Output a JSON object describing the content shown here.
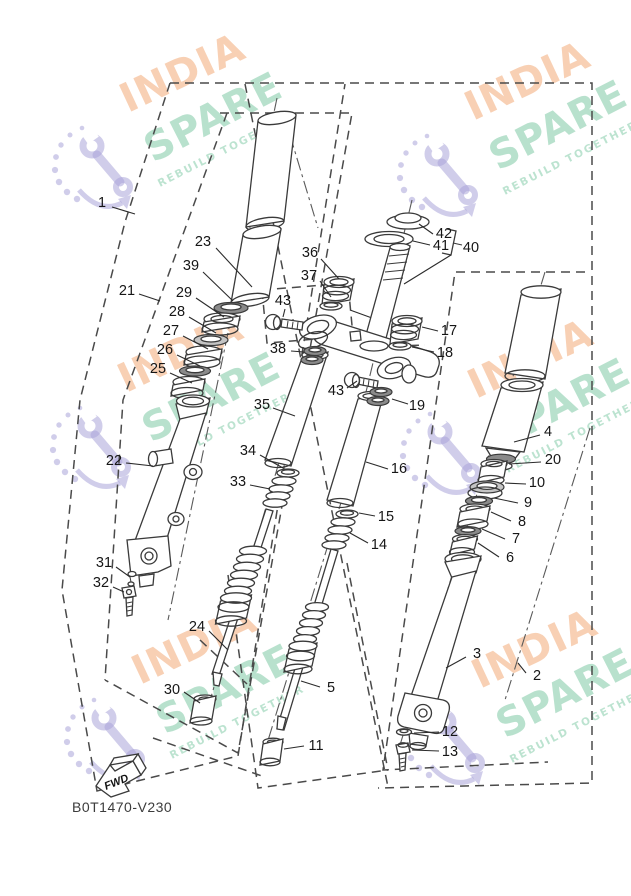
{
  "watermark": {
    "brand_top": "INDIA",
    "brand_bottom": "SPARE",
    "tagline": "REBUILD TOGETHER"
  },
  "footer": {
    "part_code": "B0T1470-V230",
    "fwd_label": "FWD"
  },
  "colors": {
    "line": "#3a3a3a",
    "watermark_orange": "#f4b182",
    "watermark_green": "#7ec9a4",
    "watermark_purple": "#aaa4d8"
  },
  "callouts": [
    {
      "n": "1",
      "x": 102,
      "y": 207,
      "l": [
        112,
        207,
        135,
        214
      ]
    },
    {
      "n": "21",
      "x": 127,
      "y": 295,
      "l": [
        139,
        294,
        160,
        301
      ]
    },
    {
      "n": "23",
      "x": 203,
      "y": 246,
      "l": [
        216,
        248,
        252,
        287
      ]
    },
    {
      "n": "39",
      "x": 191,
      "y": 270,
      "l": [
        203,
        272,
        233,
        301
      ]
    },
    {
      "n": "29",
      "x": 184,
      "y": 297,
      "l": [
        196,
        298,
        224,
        317
      ]
    },
    {
      "n": "28",
      "x": 177,
      "y": 316,
      "l": [
        189,
        317,
        216,
        333
      ]
    },
    {
      "n": "27",
      "x": 171,
      "y": 335,
      "l": [
        183,
        336,
        208,
        349
      ]
    },
    {
      "n": "26",
      "x": 165,
      "y": 354,
      "l": [
        177,
        355,
        200,
        366
      ]
    },
    {
      "n": "25",
      "x": 158,
      "y": 373,
      "l": [
        170,
        373,
        192,
        383
      ]
    },
    {
      "n": "22",
      "x": 114,
      "y": 465,
      "l": [
        126,
        463,
        153,
        466
      ]
    },
    {
      "n": "31",
      "x": 104,
      "y": 567,
      "l": [
        116,
        567,
        130,
        577
      ]
    },
    {
      "n": "32",
      "x": 101,
      "y": 587,
      "l": [
        113,
        587,
        124,
        592
      ]
    },
    {
      "n": "24",
      "x": 197,
      "y": 631,
      "l": [
        209,
        631,
        228,
        650
      ]
    },
    {
      "n": "30",
      "x": 172,
      "y": 694,
      "l": [
        184,
        692,
        200,
        703
      ]
    },
    {
      "n": "35",
      "x": 262,
      "y": 409,
      "l": [
        273,
        408,
        295,
        416
      ]
    },
    {
      "n": "34",
      "x": 248,
      "y": 455,
      "l": [
        260,
        455,
        283,
        468
      ]
    },
    {
      "n": "33",
      "x": 238,
      "y": 486,
      "l": [
        250,
        485,
        270,
        489
      ]
    },
    {
      "n": "36",
      "x": 310,
      "y": 257,
      "l": [
        321,
        259,
        339,
        279
      ]
    },
    {
      "n": "37",
      "x": 309,
      "y": 280,
      "l": [
        320,
        281,
        331,
        297
      ]
    },
    {
      "n": "43",
      "x": 283,
      "y": 305,
      "l": [
        285,
        309,
        283,
        317
      ]
    },
    {
      "n": "38",
      "x": 278,
      "y": 353,
      "l": [
        291,
        351,
        304,
        352
      ]
    },
    {
      "n": "43",
      "x": 336,
      "y": 395,
      "l": [
        347,
        388,
        357,
        381
      ]
    },
    {
      "n": "19",
      "x": 417,
      "y": 410,
      "l": [
        408,
        404,
        392,
        399
      ]
    },
    {
      "n": "17",
      "x": 449,
      "y": 335,
      "l": [
        438,
        331,
        422,
        327
      ]
    },
    {
      "n": "18",
      "x": 445,
      "y": 357,
      "l": [
        434,
        352,
        412,
        347
      ]
    },
    {
      "n": "42",
      "x": 444,
      "y": 238,
      "l": [
        433,
        234,
        419,
        224
      ]
    },
    {
      "n": "41",
      "x": 441,
      "y": 250,
      "l": [
        430,
        245,
        413,
        241
      ]
    },
    {
      "n": "40",
      "x": 471,
      "y": 252
    },
    {
      "n": "4",
      "x": 548,
      "y": 436,
      "l": [
        540,
        435,
        514,
        442
      ]
    },
    {
      "n": "20",
      "x": 553,
      "y": 464,
      "l": [
        541,
        462,
        509,
        464
      ]
    },
    {
      "n": "10",
      "x": 537,
      "y": 487,
      "l": [
        526,
        484,
        505,
        483
      ]
    },
    {
      "n": "9",
      "x": 528,
      "y": 507,
      "l": [
        518,
        503,
        494,
        498
      ]
    },
    {
      "n": "8",
      "x": 522,
      "y": 526,
      "l": [
        511,
        521,
        491,
        512
      ]
    },
    {
      "n": "7",
      "x": 516,
      "y": 543,
      "l": [
        505,
        539,
        482,
        529
      ]
    },
    {
      "n": "6",
      "x": 510,
      "y": 562,
      "l": [
        499,
        557,
        478,
        543
      ]
    },
    {
      "n": "16",
      "x": 399,
      "y": 473,
      "l": [
        388,
        469,
        366,
        462
      ]
    },
    {
      "n": "15",
      "x": 386,
      "y": 521,
      "l": [
        375,
        516,
        359,
        513
      ]
    },
    {
      "n": "14",
      "x": 379,
      "y": 549,
      "l": [
        368,
        543,
        350,
        533
      ]
    },
    {
      "n": "5",
      "x": 331,
      "y": 692,
      "l": [
        320,
        687,
        301,
        681
      ]
    },
    {
      "n": "11",
      "x": 316,
      "y": 750,
      "l": [
        304,
        746,
        284,
        749
      ]
    },
    {
      "n": "3",
      "x": 477,
      "y": 658,
      "l": [
        466,
        657,
        446,
        668
      ]
    },
    {
      "n": "2",
      "x": 537,
      "y": 680,
      "l": [
        526,
        673,
        518,
        663
      ]
    },
    {
      "n": "12",
      "x": 450,
      "y": 736,
      "l": [
        439,
        732,
        414,
        733
      ]
    },
    {
      "n": "13",
      "x": 450,
      "y": 756,
      "l": [
        439,
        751,
        412,
        750
      ]
    }
  ]
}
